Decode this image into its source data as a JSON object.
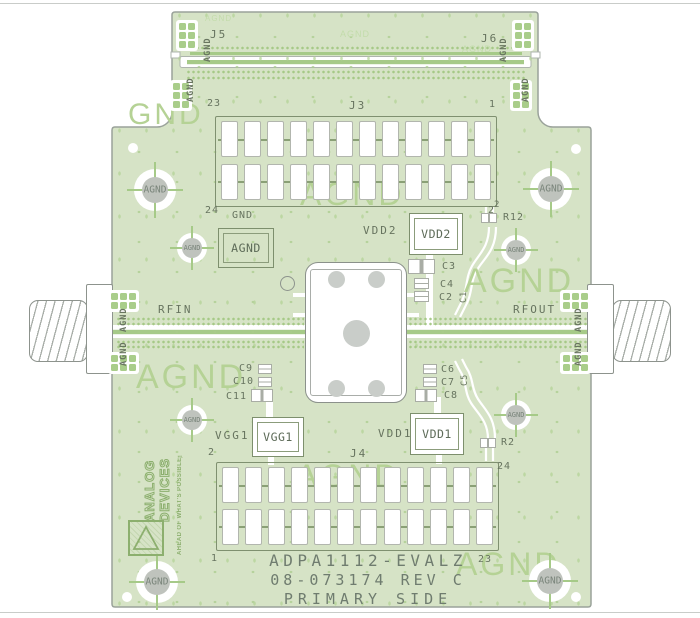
{
  "labels": {
    "agnd": "AGND",
    "gnd": "GND",
    "rfin": "RFIN",
    "rfout": "RFOUT",
    "j3": "J3",
    "j4": "J4",
    "j5": "J5",
    "j6": "J6",
    "vdd1": "VDD1",
    "vdd2": "VDD2",
    "vgg1": "VGG1"
  },
  "pins": {
    "j3": {
      "top_left": "23",
      "top_right": "1",
      "bottom_left": "24",
      "bottom_right": "2"
    },
    "j4": {
      "top_left": "2",
      "top_right": "24",
      "bottom_left": "1",
      "bottom_right": "23"
    },
    "r12_pin": "2"
  },
  "components": {
    "r12": "R12",
    "r2": "R2",
    "c1": "C1",
    "c2": "C2",
    "c3": "C3",
    "c4": "C4",
    "c5": "C5",
    "c6": "C6",
    "c7": "C7",
    "c8": "C8",
    "c9": "C9",
    "c10": "C10",
    "c11": "C11"
  },
  "watermarks": {
    "large": [
      "GND",
      "AGND",
      "AGND",
      "AGND",
      "AGND",
      "AGND"
    ],
    "small": [
      "AGND",
      "AGND",
      "AGND"
    ]
  },
  "title_block": {
    "line1": "ADPA1112-EVALZ",
    "line2": "08-073174 REV C",
    "line3": "PRIMARY SIDE"
  },
  "logo": {
    "name1": "ANALOG",
    "name2": "DEVICES",
    "tagline": "AHEAD OF WHAT'S POSSIBLE™"
  },
  "colors": {
    "board_green": "#d6e3c6",
    "outline_gray": "#9aa29a",
    "silkscreen": "#67745f",
    "watermark_green": "#b5d295",
    "pad_green": "#a9cd8a",
    "trace_green": "#a6ca88",
    "hole_gray": "#bfc3bd",
    "pad_white": "#ffffff"
  }
}
